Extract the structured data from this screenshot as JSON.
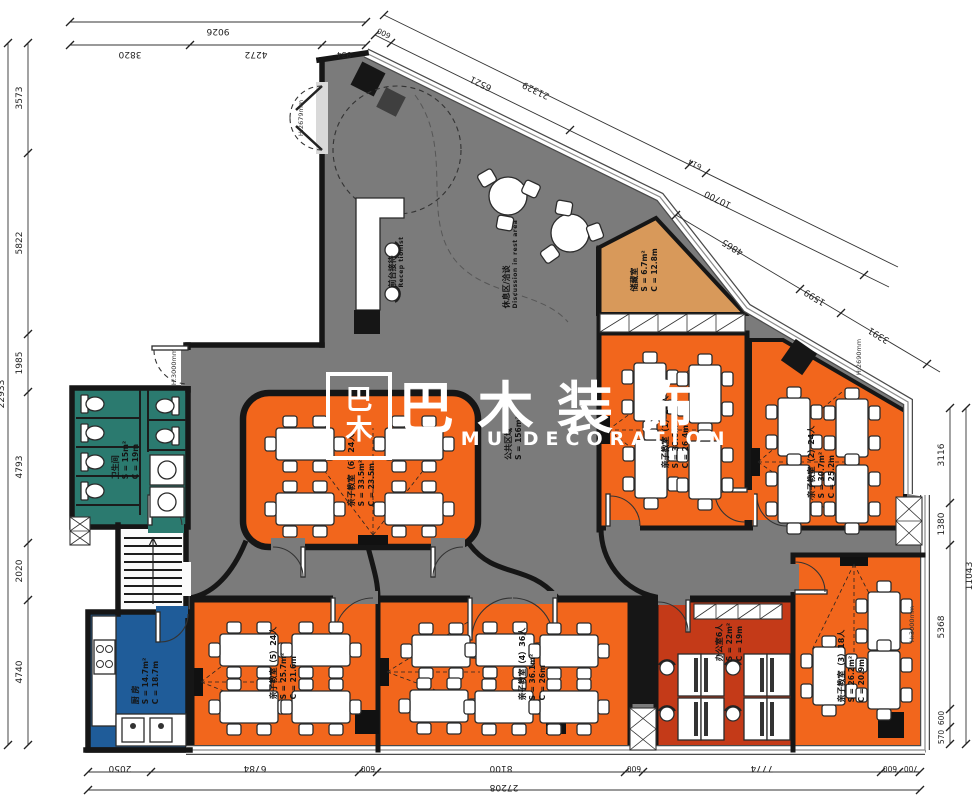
{
  "watermark": {
    "logo_glyphs": "巴木",
    "title": "巴 木 装 饰",
    "subtitle": "BA MU DECORATION"
  },
  "public_area": {
    "name": "公共区域",
    "area": "S = 156m²"
  },
  "reception": {
    "name": "前台接待",
    "name_en": "Recep tionist"
  },
  "rest_area": {
    "name": "休息区/洽谈",
    "name_en": "Discussion in rest area"
  },
  "rooms": {
    "storage": {
      "name": "储藏室",
      "area": "S = 6.7m²",
      "perimeter": "C = 12.8m"
    },
    "classroom1": {
      "name": "亲子教室（1）24人",
      "area": "S = 38.6m²",
      "perimeter": "C = 26.4m"
    },
    "classroom2": {
      "name": "亲子教室（2）24人",
      "area": "S = 30.7m²",
      "perimeter": "C = 25.2m"
    },
    "classroom3": {
      "name": "亲子教室（3）18人",
      "area": "S = 26.2m²",
      "perimeter": "C = 20.9m"
    },
    "classroom4": {
      "name": "亲子教室（4）36人",
      "area": "S = 36.1m²",
      "perimeter": "C = 26m"
    },
    "classroom5": {
      "name": "亲子教室（5）24人",
      "area": "S = 25.7m²",
      "perimeter": "C = 21.6m"
    },
    "classroom6": {
      "name": "亲子教室（6）24人",
      "area": "S = 33.5m²",
      "perimeter": "C = 23.5m"
    },
    "bathroom": {
      "name": "卫生间",
      "area": "S = 15m²",
      "perimeter": "C = 19m"
    },
    "kitchen": {
      "name": "厨 房",
      "area": "S = 14.7m²",
      "perimeter": "C = 18.7m"
    },
    "office": {
      "name": "办公室6人",
      "area": "S = 22m²",
      "perimeter": "C = 19m"
    }
  },
  "dimensions": {
    "top": {
      "total": "9026",
      "segments": [
        "3820",
        "4272",
        "934"
      ]
    },
    "left": {
      "total": "22933",
      "segments": [
        "3573",
        "5822",
        "1985",
        "4793",
        "2020",
        "4740"
      ]
    },
    "bottom": {
      "total": "27208",
      "segments": [
        "2050",
        "6784",
        "600",
        "8100",
        "600",
        "7774",
        "600",
        "700"
      ]
    },
    "right": {
      "total": "11043",
      "segments": [
        "3116",
        "1380",
        "5368",
        "600",
        "570"
      ]
    },
    "diagonal_inner": [
      "600",
      "6521",
      "10700"
    ],
    "diagonal_outer": [
      "21329",
      "614"
    ],
    "diagonal_lower": [
      "4865",
      "1599",
      "3391"
    ]
  },
  "height_labels": {
    "entrance": "H:2679mm",
    "side_door": "H:3000mm",
    "storage_wall": "H:2690mm",
    "right_wall": "H:3000mm"
  },
  "colors": {
    "floor": "#7b7b7b",
    "classroom": "#F2661C",
    "storage": "#D8995A",
    "bathroom": "#2B7A6F",
    "kitchen": "#1F5C99",
    "office": "#C43A18",
    "wall": "#161616",
    "watermark": "#ffffff"
  }
}
